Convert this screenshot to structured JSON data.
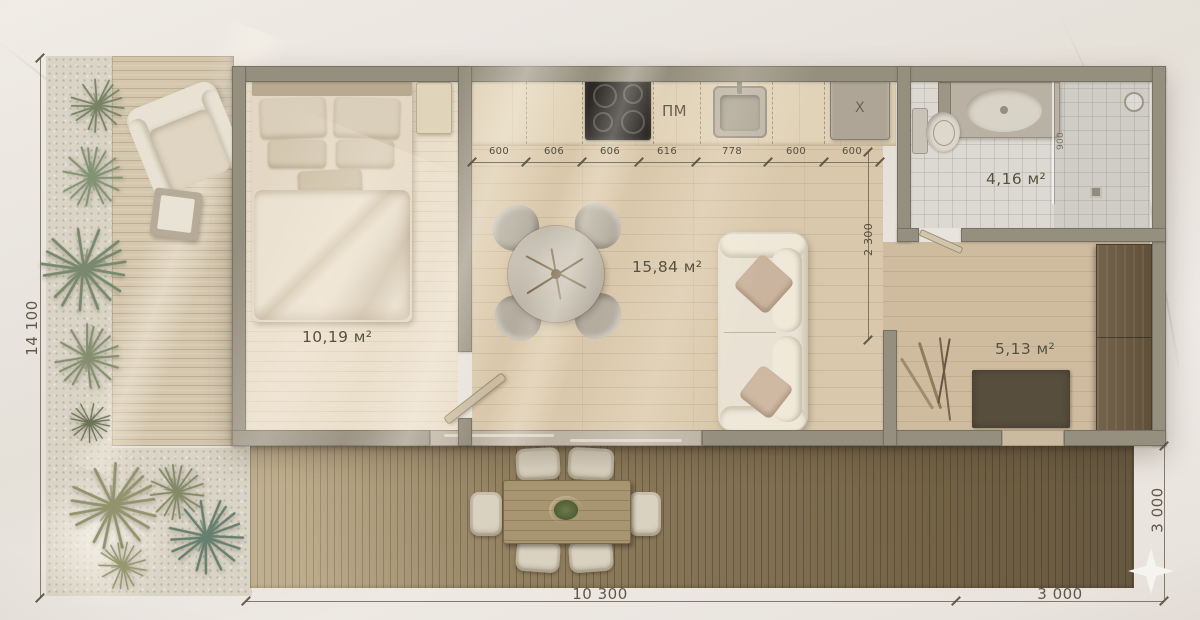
{
  "labels": {
    "bedroom_area": "10,19 м²",
    "living_area": "15,84 м²",
    "bathroom_area": "4,16 м²",
    "entry_area": "5,13 м²",
    "dishwasher": "ПМ",
    "boiler": "X"
  },
  "cabinet_dims": [
    "600",
    "606",
    "606",
    "616",
    "778",
    "600",
    "600"
  ],
  "dims": {
    "total_height": "14 100",
    "bottom_house": "10 300",
    "bottom_deck": "3 000",
    "right_deck": "3 000",
    "kitchen_depth": "2 300",
    "shower_width": "900"
  },
  "colors": {
    "wall": "#8f8a7b",
    "living_floor": "#d8c8aa",
    "deck_dark": "#7b6b4b",
    "accent_text": "#56513f"
  }
}
